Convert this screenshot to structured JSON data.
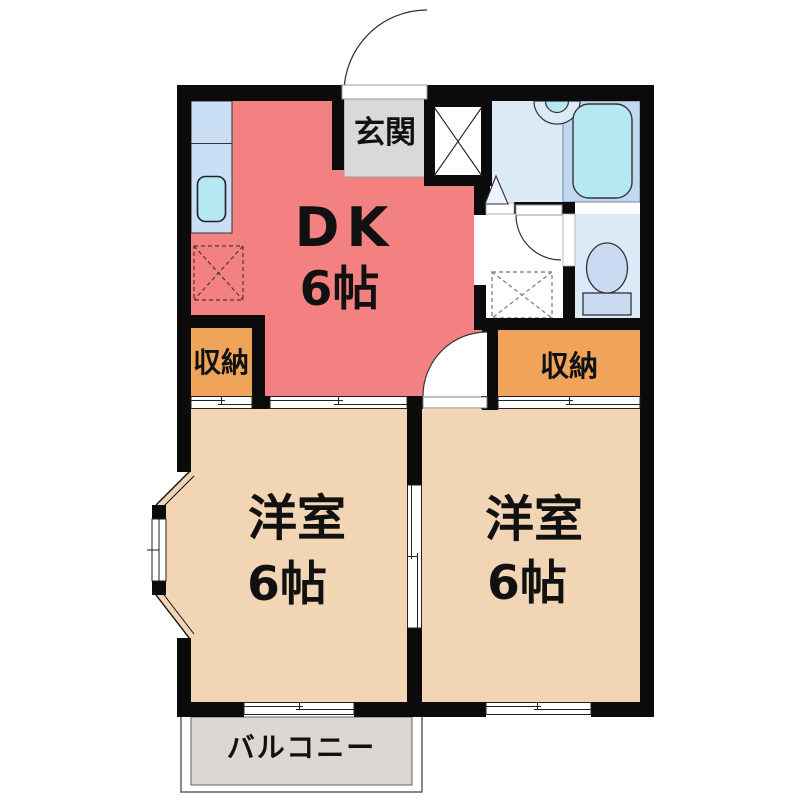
{
  "floorplan": {
    "labels": {
      "entrance": "玄関",
      "dk_name": "DK",
      "dk_size": "6帖",
      "closet_left": "収納",
      "closet_right": "収納",
      "room_left_name": "洋室",
      "room_left_size": "6帖",
      "room_right_name": "洋室",
      "room_right_size": "6帖",
      "balcony": "バルコニー"
    },
    "colors": {
      "wall": "#0b0b0b",
      "dk": "#f48181",
      "room": "#f2d5b5",
      "closet": "#efa45a",
      "entrance": "#d9d9d9",
      "bath_floor": "#dce9f7",
      "bath_deck": "#c3d8ef",
      "water": "#b5e9f2",
      "counter": "#cadef5",
      "toilet": "#c9daf2",
      "balcony": "#dbd7d3",
      "line": "#222222"
    },
    "fixtures": {
      "kitchen_counter": "kitchen-counter-with-sink",
      "bathtub": "bathtub",
      "washbasin": "washbasin",
      "toilet": "toilet",
      "washing_machine_space": "washing-machine-space",
      "refrigerator_space": "refrigerator-space",
      "shoe_cabinet": "shoe-cabinet"
    }
  }
}
